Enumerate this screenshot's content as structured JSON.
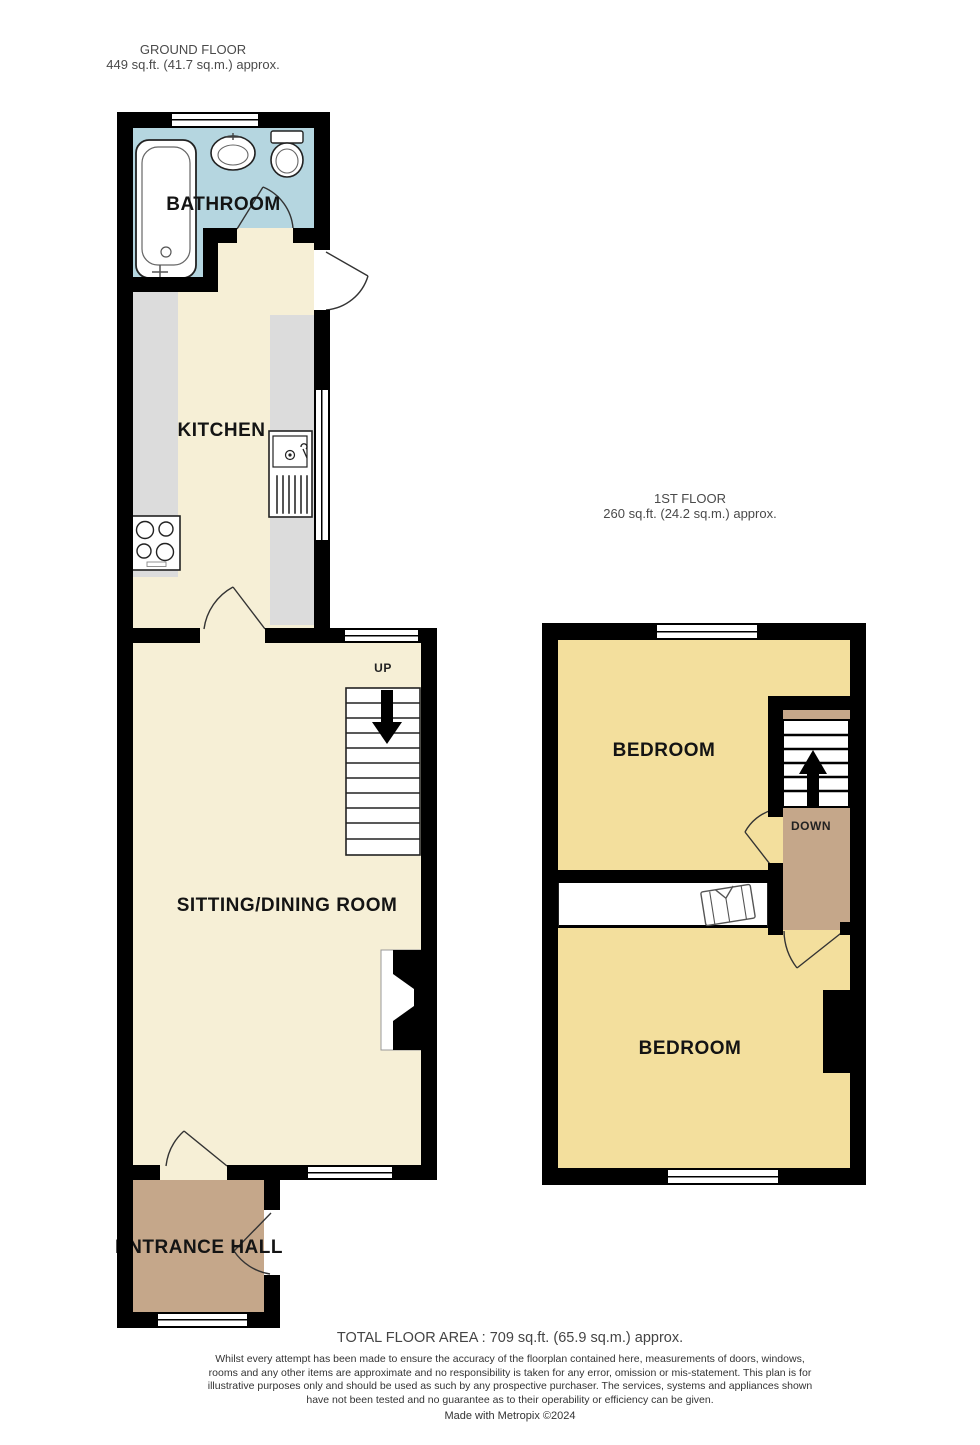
{
  "ground_floor": {
    "header_title": "GROUND FLOOR",
    "header_area": "449 sq.ft. (41.7 sq.m.) approx.",
    "rooms": {
      "bathroom": "BATHROOM",
      "kitchen": "KITCHEN",
      "sitting_dining": "SITTING/DINING ROOM",
      "entrance_hall": "ENTRANCE HALL"
    },
    "stairs_label": "UP"
  },
  "first_floor": {
    "header_title": "1ST FLOOR",
    "header_area": "260 sq.ft. (24.2 sq.m.) approx.",
    "rooms": {
      "bedroom_front": "BEDROOM",
      "bedroom_back": "BEDROOM"
    },
    "stairs_label": "DOWN"
  },
  "footer": {
    "total_area": "TOTAL FLOOR AREA : 709 sq.ft. (65.9 sq.m.) approx.",
    "disclaimer": "Whilst every attempt has been made to ensure the accuracy of the floorplan contained here, measurements of doors, windows, rooms and any other items are approximate and no responsibility is taken for any error, omission or mis-statement. This plan is for illustrative purposes only and should be used as such by any prospective purchaser. The services, systems and appliances shown have not been tested and no guarantee as to their operability or efficiency can be given.",
    "credit": "Made with Metropix ©2024"
  },
  "colors": {
    "wall": "#000000",
    "bathroom": "#b5d6e0",
    "floor_cream": "#f6efd6",
    "bedroom": "#f3df9d",
    "tan": "#c5a78a",
    "counter": "#dcdcdc"
  }
}
